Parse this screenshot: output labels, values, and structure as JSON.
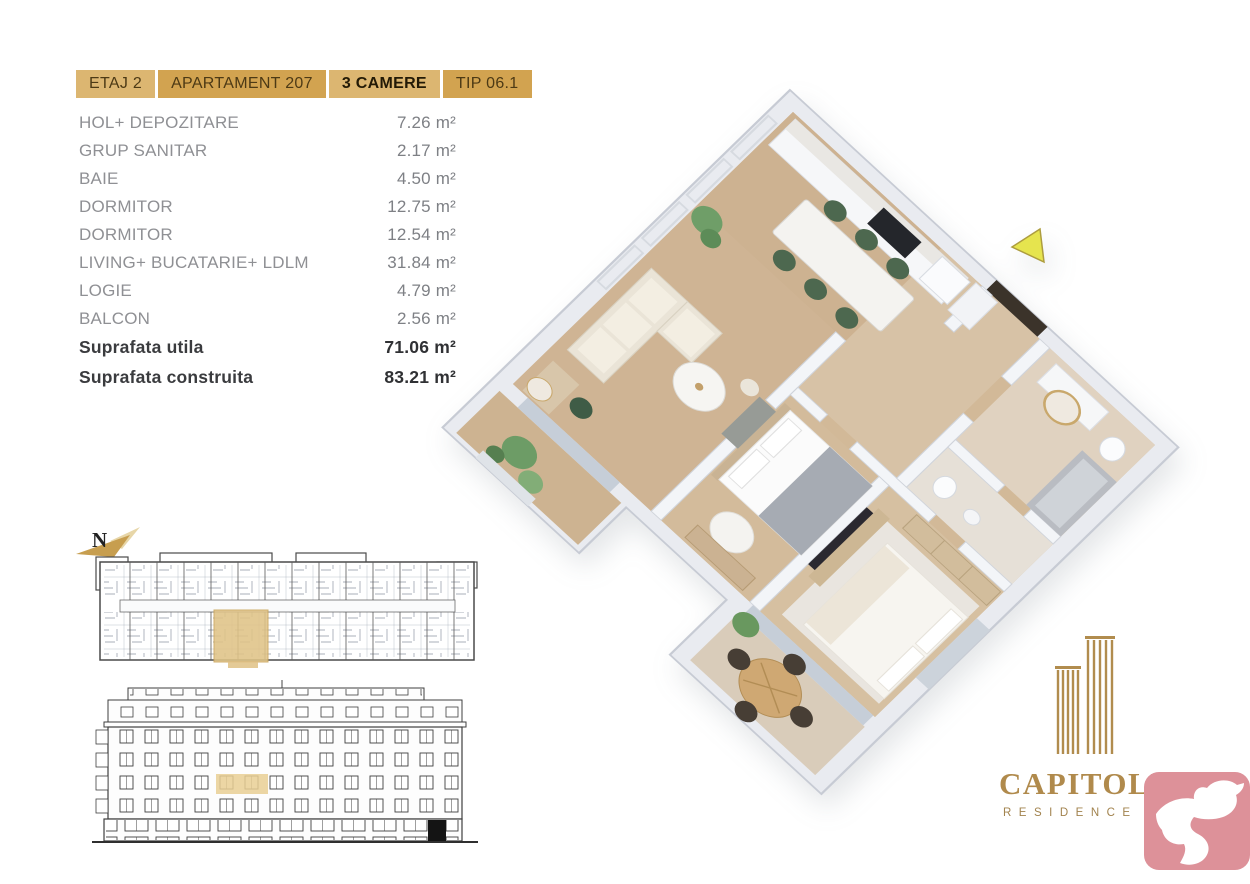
{
  "header": {
    "tabs": [
      {
        "label": "ETAJ 2",
        "tone": "light"
      },
      {
        "label": "APARTAMENT 207",
        "tone": "dark"
      },
      {
        "label": "3 CAMERE",
        "tone": "light-bold"
      },
      {
        "label": "TIP 06.1",
        "tone": "dark"
      }
    ]
  },
  "areas": {
    "unit": "m²",
    "rows": [
      {
        "label": "HOL+ DEPOZITARE",
        "value": "7.26"
      },
      {
        "label": "GRUP SANITAR",
        "value": "2.17"
      },
      {
        "label": "BAIE",
        "value": "4.50"
      },
      {
        "label": "DORMITOR",
        "value": "12.75"
      },
      {
        "label": "DORMITOR",
        "value": "12.54"
      },
      {
        "label": "LIVING+ BUCATARIE+ LDLM",
        "value": "31.84"
      },
      {
        "label": "LOGIE",
        "value": "4.79"
      },
      {
        "label": "BALCON",
        "value": "2.56"
      }
    ],
    "totals": [
      {
        "label": "Suprafata utila",
        "value": "71.06"
      },
      {
        "label": "Suprafata construita",
        "value": "83.21"
      }
    ]
  },
  "site_plan": {
    "north_label": "N"
  },
  "brand": {
    "name": "CAPITOLIA",
    "subtitle": "RESIDENCE"
  },
  "icons": {
    "north_arrow": "north-arrow-icon",
    "orientation_triangle": "orientation-triangle-icon",
    "brand_towers": "building-towers-icon",
    "dove_badge": "dove-icon"
  },
  "colors": {
    "tab_light": "#dcb671",
    "tab_dark": "#d2a350",
    "unit_highlight": "#e3c487",
    "brand_gold": "#b08a4c",
    "badge_pink": "#dd9199",
    "floor_wood": "#cfb494",
    "wall_white": "#f2f4f7",
    "plant_green": "#6f9e68",
    "chair_green": "#4d684f"
  }
}
